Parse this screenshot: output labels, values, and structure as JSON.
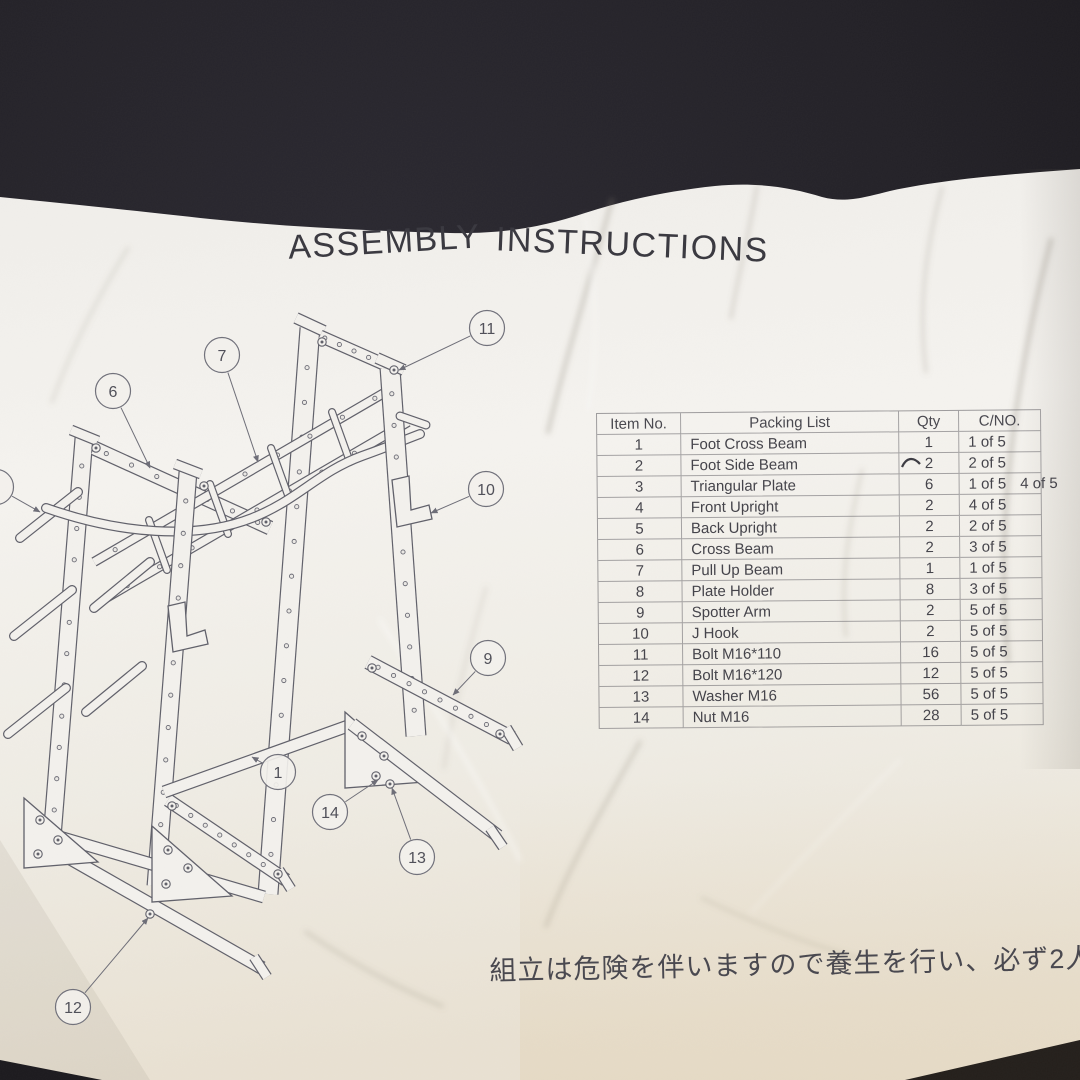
{
  "title": "ASSEMBLY INSTRUCTIONS",
  "title_words": [
    "ASSEMBLY",
    "INSTRUCTIONS"
  ],
  "caution_jp": "組立は危険を伴いますので養生を行い、必ず2人以上で行",
  "colors": {
    "background": "#232127",
    "paper": "#f3f1ed",
    "ink_line": "#60606a",
    "ink_text": "#3b3a41"
  },
  "table": {
    "headers": [
      "Item No.",
      "Packing List",
      "Qty",
      "C/NO."
    ],
    "rows": [
      {
        "item": "1",
        "name": "Foot Cross Beam",
        "qty": "1",
        "cno": "1 of 5"
      },
      {
        "item": "2",
        "name": "Foot Side Beam",
        "qty": "2",
        "cno": "2 of 5"
      },
      {
        "item": "3",
        "name": "Triangular Plate",
        "qty": "6",
        "cno": "1 of 5",
        "cno2": "4 of 5"
      },
      {
        "item": "4",
        "name": "Front Upright",
        "qty": "2",
        "cno": "4 of 5"
      },
      {
        "item": "5",
        "name": "Back Upright",
        "qty": "2",
        "cno": "2 of 5"
      },
      {
        "item": "6",
        "name": "Cross Beam",
        "qty": "2",
        "cno": "3 of 5"
      },
      {
        "item": "7",
        "name": "Pull Up Beam",
        "qty": "1",
        "cno": "1 of 5"
      },
      {
        "item": "8",
        "name": "Plate Holder",
        "qty": "8",
        "cno": "3 of 5"
      },
      {
        "item": "9",
        "name": "Spotter Arm",
        "qty": "2",
        "cno": "5 of 5"
      },
      {
        "item": "10",
        "name": "J Hook",
        "qty": "2",
        "cno": "5 of 5"
      },
      {
        "item": "11",
        "name": "Bolt M16*110",
        "qty": "16",
        "cno": "5 of 5"
      },
      {
        "item": "12",
        "name": "Bolt M16*120",
        "qty": "12",
        "cno": "5 of 5"
      },
      {
        "item": "13",
        "name": "Washer M16",
        "qty": "56",
        "cno": "5 of 5"
      },
      {
        "item": "14",
        "name": "Nut M16",
        "qty": "28",
        "cno": "5 of 5"
      }
    ]
  },
  "diagram": {
    "callouts": [
      {
        "num": "8",
        "cx": -4,
        "cy": 487,
        "lx": 40,
        "ly": 512
      },
      {
        "num": "7",
        "cx": 222,
        "cy": 355,
        "lx": 258,
        "ly": 462
      },
      {
        "num": "6",
        "cx": 113,
        "cy": 391,
        "lx": 150,
        "ly": 468
      },
      {
        "num": "11",
        "cx": 487,
        "cy": 328,
        "lx": 399,
        "ly": 370
      },
      {
        "num": "10",
        "cx": 486,
        "cy": 489,
        "lx": 431,
        "ly": 513
      },
      {
        "num": "9",
        "cx": 488,
        "cy": 658,
        "lx": 453,
        "ly": 695
      },
      {
        "num": "1",
        "cx": 278,
        "cy": 772,
        "lx": 252,
        "ly": 757
      },
      {
        "num": "14",
        "cx": 330,
        "cy": 812,
        "lx": 378,
        "ly": 780
      },
      {
        "num": "13",
        "cx": 417,
        "cy": 857,
        "lx": 392,
        "ly": 788
      },
      {
        "num": "12",
        "cx": 73,
        "cy": 1007,
        "lx": 148,
        "ly": 918
      }
    ]
  }
}
